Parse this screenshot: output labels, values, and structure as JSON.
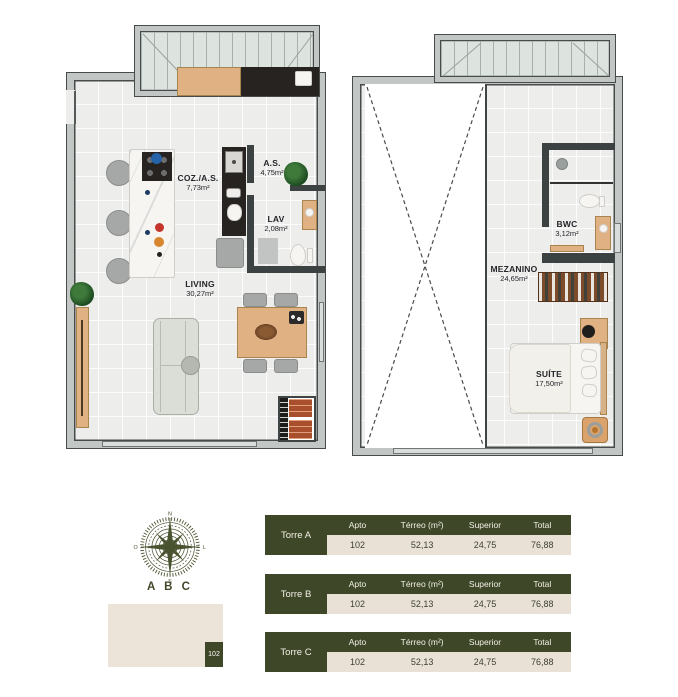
{
  "colors": {
    "accent_green": "#3e4727",
    "table_beige": "#e9e1d5",
    "keyplan_beige": "#ece4d9",
    "wall_gray": "#c2c7c6",
    "wall_line": "#474c4b",
    "floor_gray": "#ededec",
    "wood": "#e0b183",
    "brick": "#a8502e"
  },
  "ground_floor": {
    "rooms": {
      "coz": {
        "name": "COZ./A.S.",
        "area": "7,73m²"
      },
      "as": {
        "name": "A.S.",
        "area": "4,75m²"
      },
      "lav": {
        "name": "LAV",
        "area": "2,08m²"
      },
      "living": {
        "name": "LIVING",
        "area": "30,27m²"
      }
    }
  },
  "upper_floor": {
    "rooms": {
      "mezanino": {
        "name": "MEZANINO",
        "area": "24,65m²"
      },
      "bwc": {
        "name": "BWC",
        "area": "3,12m²"
      },
      "suite": {
        "name": "SUÍTE",
        "area": "17,50m²"
      }
    }
  },
  "compass": {
    "label": "A B C",
    "north": "N",
    "south": "S",
    "east": "L",
    "west": "O"
  },
  "keyplan": {
    "unit": "102"
  },
  "tables": [
    {
      "tower": "Torre A",
      "headers": [
        "Apto",
        "Térreo (m²)",
        "Superior",
        "Total"
      ],
      "values": [
        "102",
        "52,13",
        "24,75",
        "76,88"
      ]
    },
    {
      "tower": "Torre B",
      "headers": [
        "Apto",
        "Térreo (m²)",
        "Superior",
        "Total"
      ],
      "values": [
        "102",
        "52,13",
        "24,75",
        "76,88"
      ]
    },
    {
      "tower": "Torre C",
      "headers": [
        "Apto",
        "Térreo (m²)",
        "Superior",
        "Total"
      ],
      "values": [
        "102",
        "52,13",
        "24,75",
        "76,88"
      ]
    }
  ]
}
